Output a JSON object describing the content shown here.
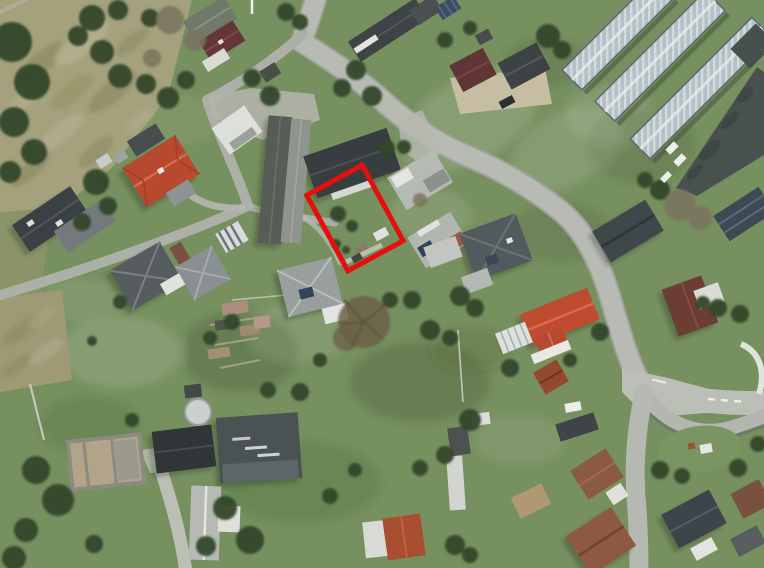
{
  "meta": {
    "type": "aerial-orthophoto",
    "description": "Aerial photograph of a village with streets, houses, gardens, greenhouses and a property parcel outlined by a red rectangle",
    "width_px": 764,
    "height_px": 568
  },
  "annotation": {
    "name": "highlighted-parcel",
    "shape": "rectangle",
    "stroke_color": "#e60e0e",
    "stroke_width_px": 5,
    "center_x": 355,
    "center_y": 218,
    "width_px": 63,
    "height_px": 86,
    "rotation_deg": -28.5
  },
  "scene": {
    "ground_colors": {
      "grass": "#76905f",
      "scrub_field": "#a4a17c",
      "road": "#b8bbb3",
      "tree": "#33472e"
    },
    "roads": [
      {
        "name": "main-road",
        "path": "from top edge curving south-east to junction at lower right"
      },
      {
        "name": "narrow-street",
        "path": "forks from main road, bends south-west to left edge"
      },
      {
        "name": "junction-branch-right",
        "path": "from junction to right edge with curved loop"
      },
      {
        "name": "junction-branch-down",
        "path": "from junction to bottom edge"
      }
    ],
    "landmarks": [
      {
        "name": "highlighted-parcel-garden",
        "approx": [
          355,
          218
        ]
      },
      {
        "name": "red-tile-roof-house-west",
        "approx": [
          161,
          171
        ]
      },
      {
        "name": "red-tile-roof-house-southeast",
        "approx": [
          558,
          320
        ]
      },
      {
        "name": "farm-barn-long-building",
        "approx": [
          285,
          180
        ]
      },
      {
        "name": "dark-roof-building-north-of-parcel",
        "approx": [
          352,
          163
        ]
      },
      {
        "name": "greenhouse-complex",
        "approx": [
          660,
          60
        ]
      },
      {
        "name": "industrial-dark-roof",
        "approx": [
          715,
          130
        ]
      },
      {
        "name": "road-junction-loop",
        "approx": [
          690,
          410
        ]
      }
    ],
    "greenhouses": {
      "count": 3,
      "angle_deg": -45,
      "glass_color": "#bac4c8"
    },
    "vehicles": {
      "white_cars": 4,
      "dark_cars": 1
    }
  }
}
